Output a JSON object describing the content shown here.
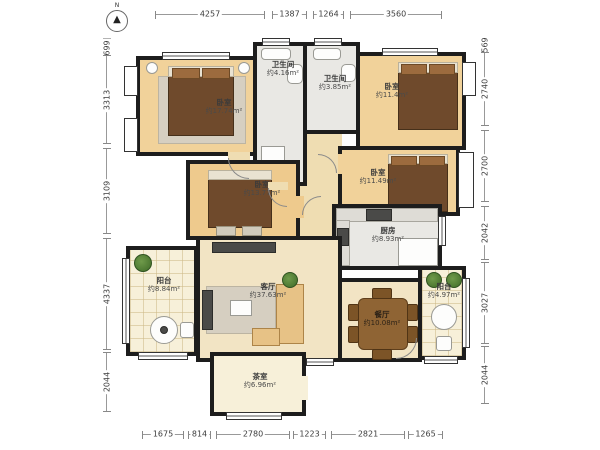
{
  "plan": {
    "compass": {
      "label": "N",
      "arrow": "▲"
    },
    "rooms": [
      {
        "id": "bedroom-master",
        "name": "卧室",
        "area": "约17.74m²"
      },
      {
        "id": "bathroom-1",
        "name": "卫生间",
        "area": "约4.16m²"
      },
      {
        "id": "bathroom-2",
        "name": "卫生间",
        "area": "约3.85m²"
      },
      {
        "id": "bedroom-top-right",
        "name": "卧室",
        "area": "约11.4m²"
      },
      {
        "id": "bedroom-mid-right",
        "name": "卧室",
        "area": "约11.49m²"
      },
      {
        "id": "bedroom-left",
        "name": "卧室",
        "area": "约13.77m²"
      },
      {
        "id": "kitchen",
        "name": "厨房",
        "area": "约8.93m²"
      },
      {
        "id": "balcony-left",
        "name": "阳台",
        "area": "约8.84m²"
      },
      {
        "id": "living-room",
        "name": "客厅",
        "area": "约37.63m²"
      },
      {
        "id": "dining-room",
        "name": "餐厅",
        "area": "约10.08m²"
      },
      {
        "id": "balcony-right",
        "name": "阳台",
        "area": "约4.97m²"
      },
      {
        "id": "tea-room",
        "name": "茶室",
        "area": "约6.96m²"
      }
    ],
    "dimensions": {
      "top": [
        "4257",
        "1387",
        "1264",
        "3560"
      ],
      "bottom": [
        "1675",
        "814",
        "2780",
        "1223",
        "2821",
        "1265"
      ],
      "left": [
        "699",
        "3313",
        "3109",
        "4337",
        "2044"
      ],
      "right": [
        "569",
        "2740",
        "2700",
        "2042",
        "3027",
        "2044"
      ]
    },
    "colors": {
      "wall": "#1d1d1d",
      "wood_floor": "#f1d29a",
      "tile_floor": "#e9e8e4",
      "beige_floor": "#f2e4c4"
    }
  }
}
